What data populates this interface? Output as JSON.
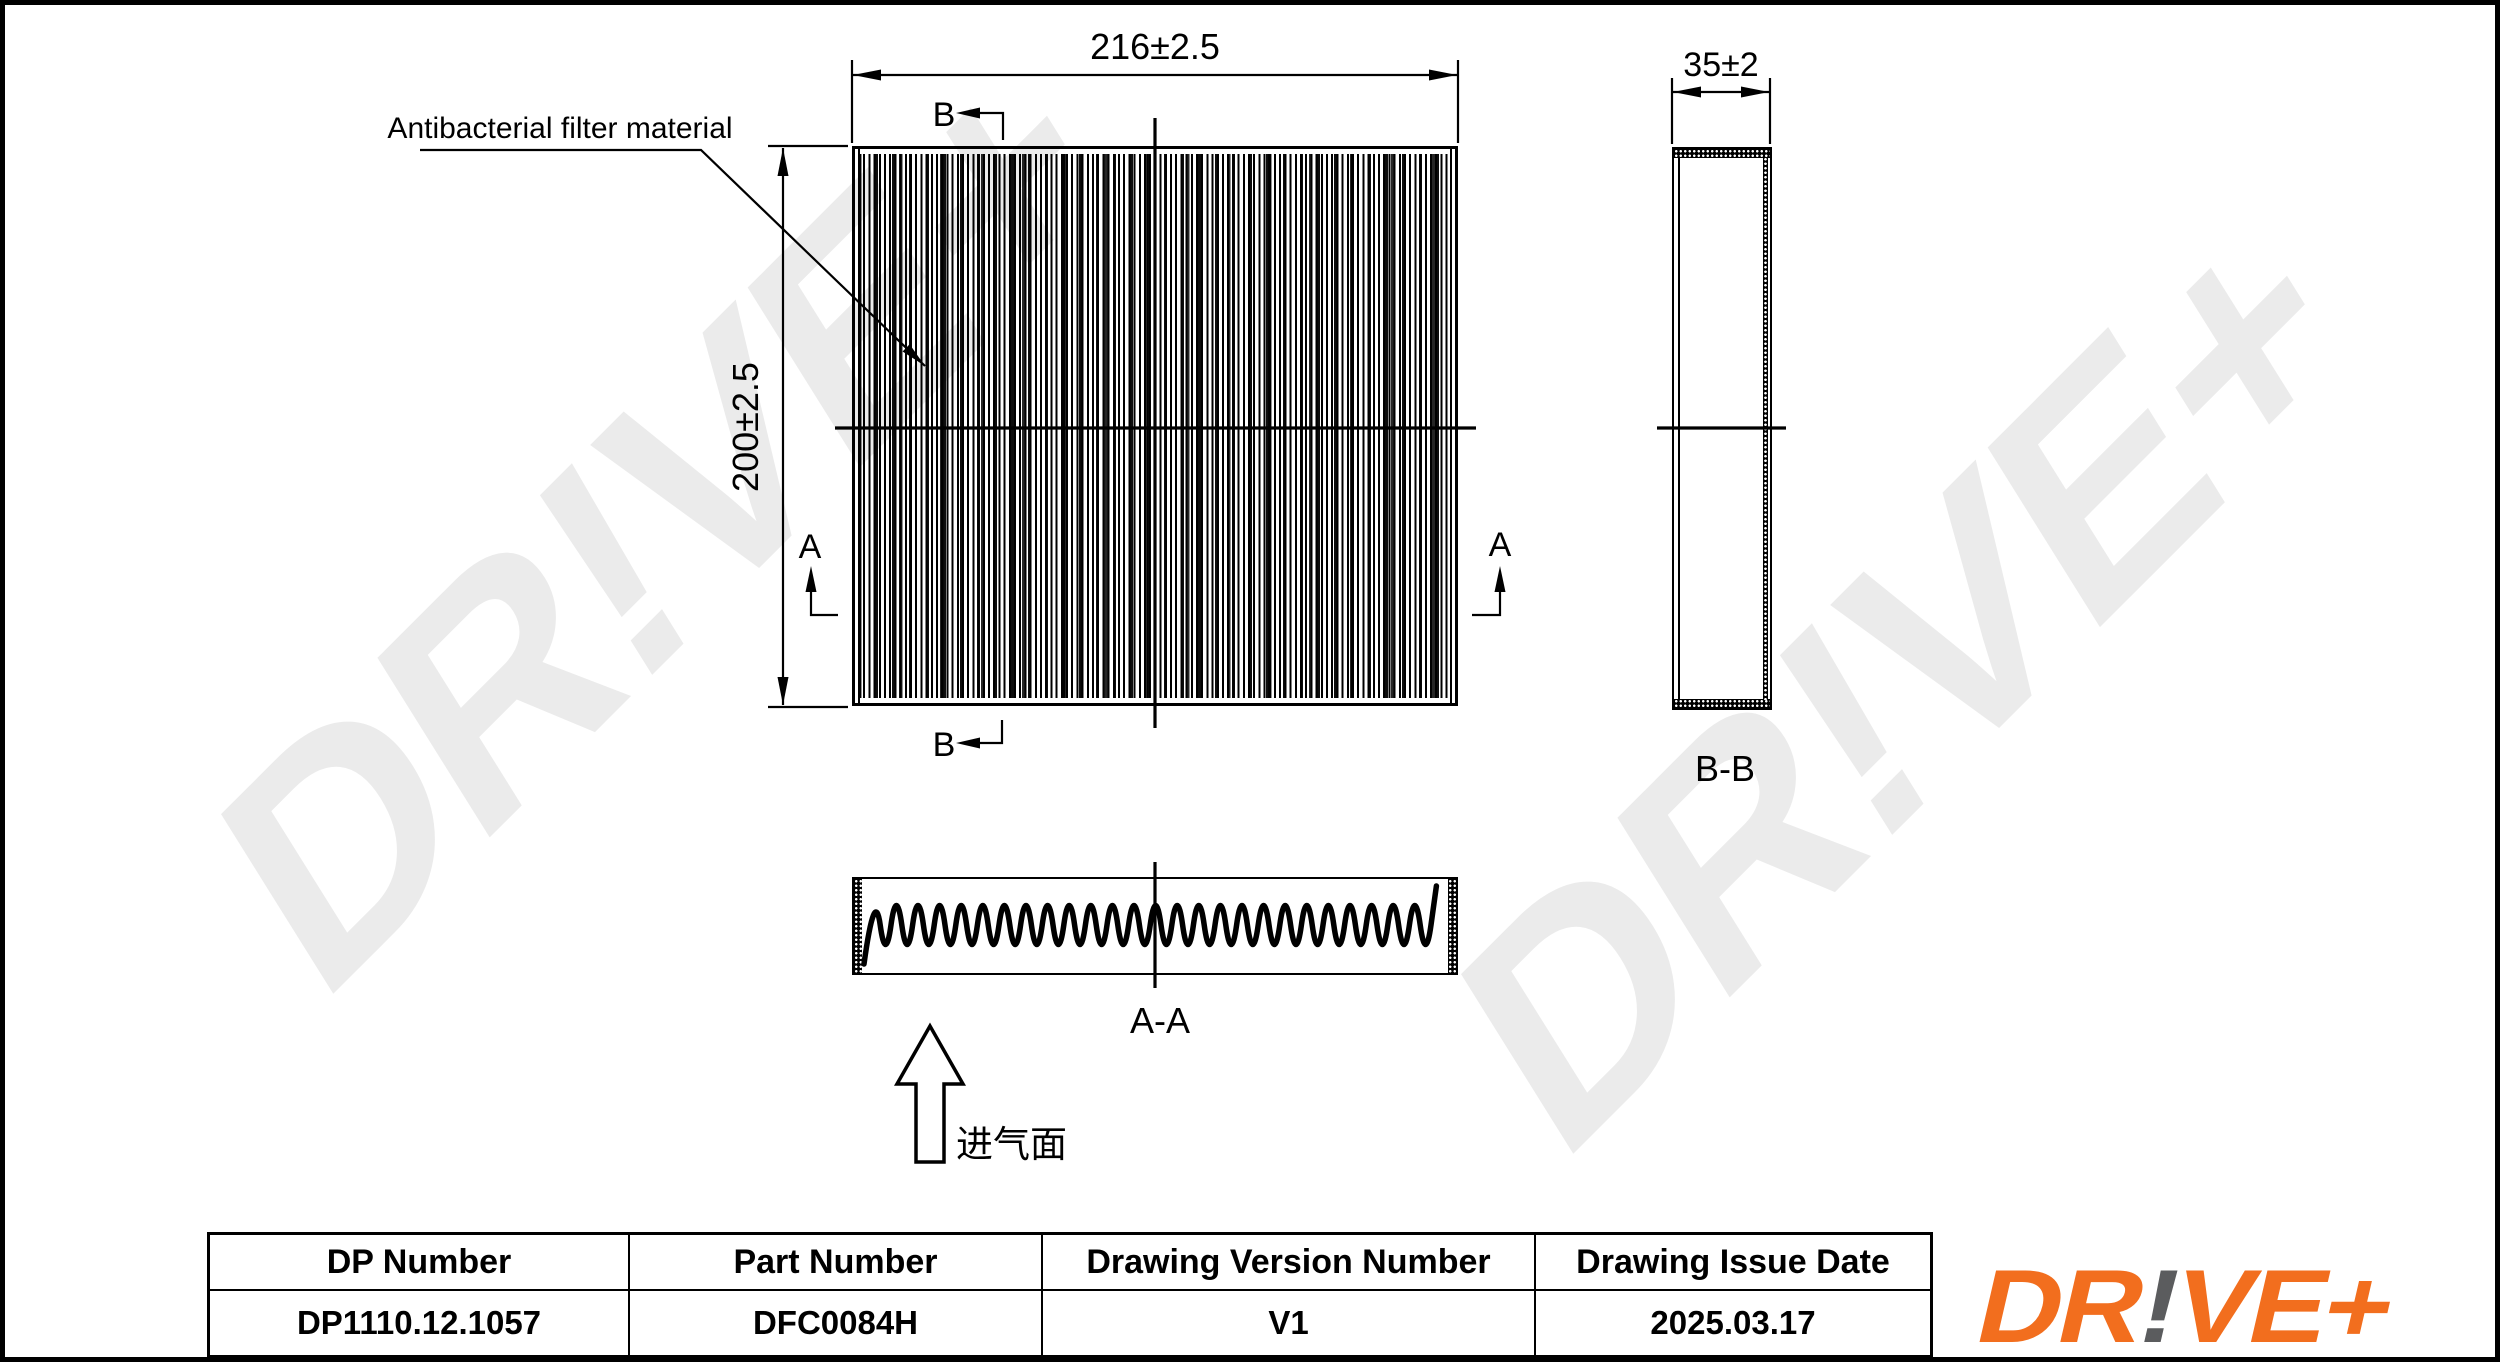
{
  "watermark": {
    "text": "DR!VE+",
    "color": "#ebebeb"
  },
  "drawing": {
    "material_label": "Antibacterial filter material",
    "intake_label": "进气面",
    "dim_width": "216±2.5",
    "dim_height": "200±2.5",
    "dim_depth": "35±2",
    "section_a": "A",
    "section_b": "B",
    "section_view_aa": "A-A",
    "section_view_bb": "B-B"
  },
  "title_block": {
    "columns": [
      {
        "header": "DP Number",
        "value": "DP1110.12.1057"
      },
      {
        "header": "Part Number",
        "value": "DFC0084H"
      },
      {
        "header": "Drawing Version Number",
        "value": "V1"
      },
      {
        "header": "Drawing Issue Date",
        "value": "2025.03.17"
      }
    ]
  },
  "logo": {
    "part1": "DR",
    "bang": "!",
    "part2": "VE+",
    "orange": "#f26e1e",
    "gray": "#5b5c5e"
  }
}
